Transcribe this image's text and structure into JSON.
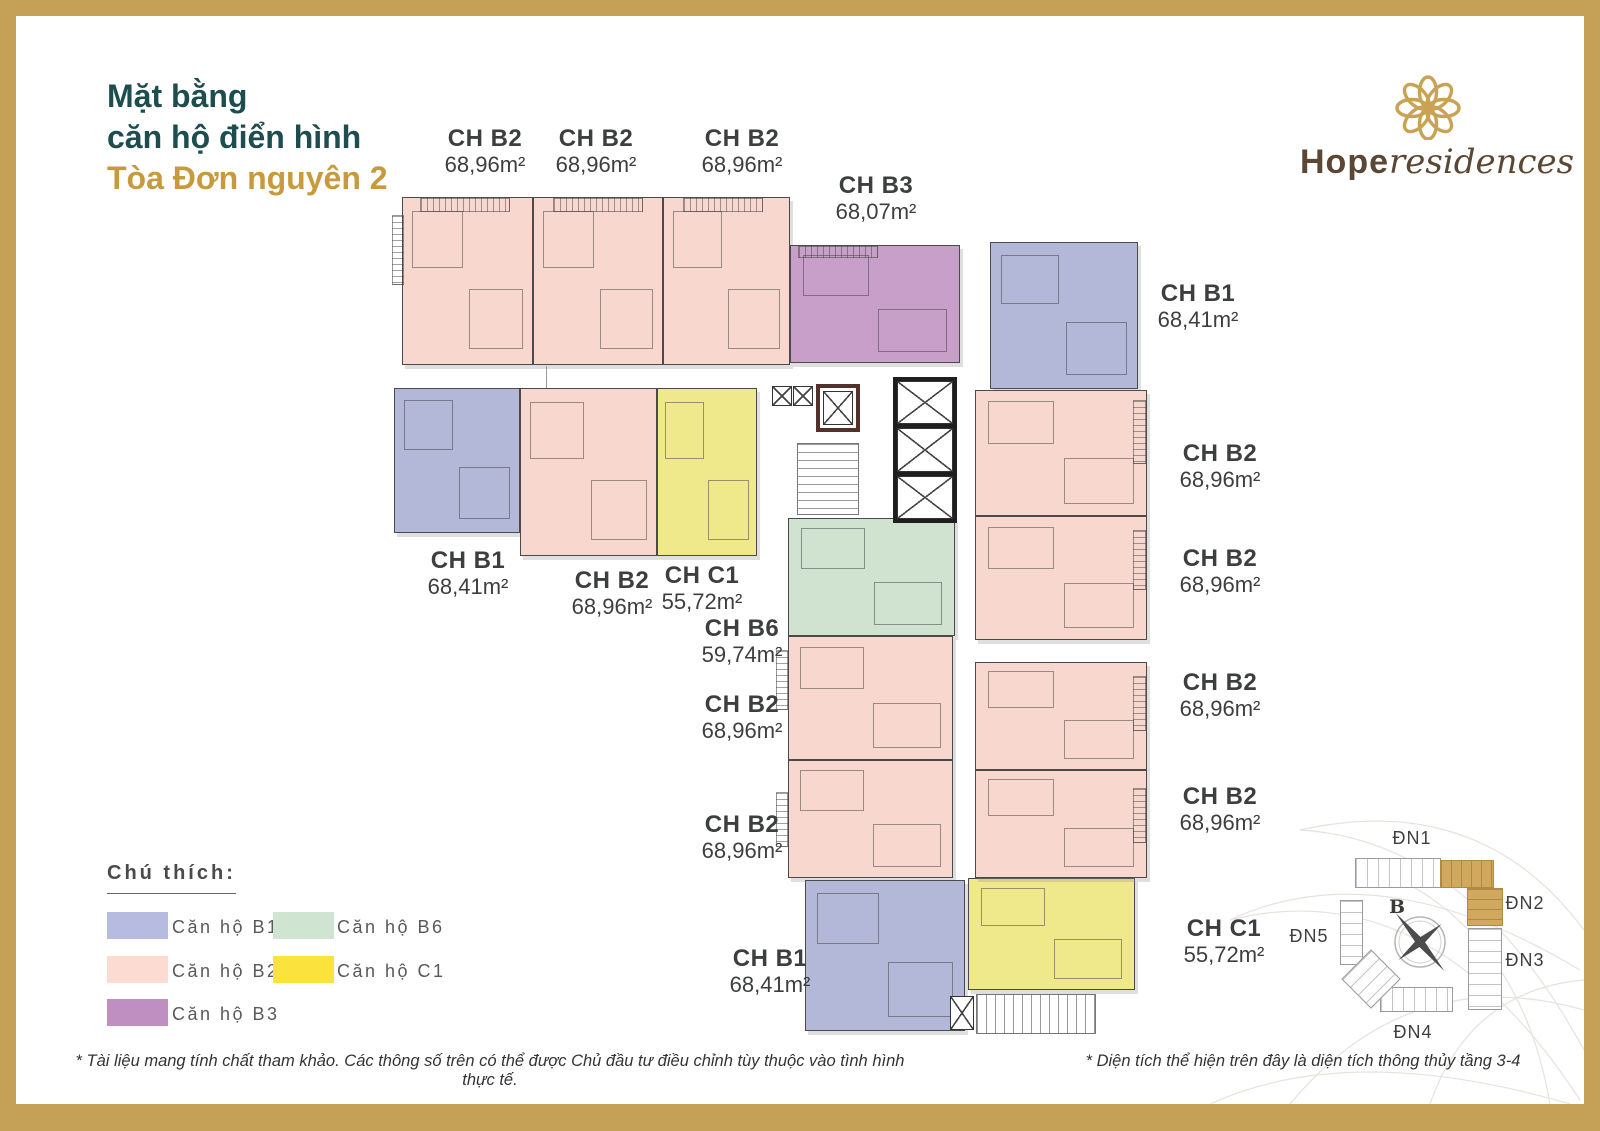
{
  "title": {
    "line1": "Mặt bằng",
    "line2": "căn hộ điển hình",
    "line3": "Tòa Đơn nguyên 2"
  },
  "logo": {
    "brand_primary": "Hope",
    "brand_secondary": "residences"
  },
  "plan": {
    "unit_labels": [
      {
        "name": "CH B2",
        "area": "68,96m²"
      },
      {
        "name": "CH B2",
        "area": "68,96m²"
      },
      {
        "name": "CH B2",
        "area": "68,96m²"
      },
      {
        "name": "CH B3",
        "area": "68,07m²"
      },
      {
        "name": "CH B1",
        "area": "68,41m²"
      },
      {
        "name": "CH B2",
        "area": "68,96m²"
      },
      {
        "name": "CH B2",
        "area": "68,96m²"
      },
      {
        "name": "CH B2",
        "area": "68,96m²"
      },
      {
        "name": "CH B2",
        "area": "68,96m²"
      },
      {
        "name": "CH B1",
        "area": "68,41m²"
      },
      {
        "name": "CH B2",
        "area": "68,96m²"
      },
      {
        "name": "CH C1",
        "area": "55,72m²"
      },
      {
        "name": "CH B6",
        "area": "59,74m²"
      },
      {
        "name": "CH B2",
        "area": "68,96m²"
      },
      {
        "name": "CH B2",
        "area": "68,96m²"
      },
      {
        "name": "CH B1",
        "area": "68,41m²"
      },
      {
        "name": "CH C1",
        "area": "55,72m²"
      }
    ]
  },
  "legend": {
    "heading": "Chú thích:",
    "items": [
      {
        "label": "Căn hộ B1"
      },
      {
        "label": "Căn hộ B2"
      },
      {
        "label": "Căn hộ B3"
      },
      {
        "label": "Căn hộ B6"
      },
      {
        "label": "Căn hộ C1"
      }
    ]
  },
  "site_map": {
    "buildings": [
      {
        "label": "ĐN1"
      },
      {
        "label": "ĐN2"
      },
      {
        "label": "ĐN3"
      },
      {
        "label": "ĐN4"
      },
      {
        "label": "ĐN5"
      }
    ],
    "compass_label": "B",
    "highlighted_building": "ĐN2"
  },
  "footnotes": {
    "left": "* Tài liệu mang tính chất tham khảo.  Các thông số trên có thể được Chủ đầu tư điều chỉnh tùy thuộc vào tình hình thực tế.",
    "right": "* Diện tích thể hiện trên đây là diện tích thông thủy tầng 3-4"
  },
  "colors": {
    "unit_b1": "#b3b8d9",
    "unit_b2": "#f8d8ce",
    "unit_b3": "#c79fc8",
    "unit_b6": "#cfe3d0",
    "unit_c1": "#f0e98c",
    "legend_b1": "#b6bbdf",
    "legend_b2": "#fcdcd2",
    "legend_b3": "#c08fc1",
    "legend_b6": "#cfe5d2",
    "legend_c1": "#fbe23d",
    "site_highlight": "#d2a85f",
    "frame_gold": "#c5a157",
    "title_teal": "#1d4d4f",
    "title_gold": "#c89a3e",
    "brand_brown": "#5b4734"
  }
}
